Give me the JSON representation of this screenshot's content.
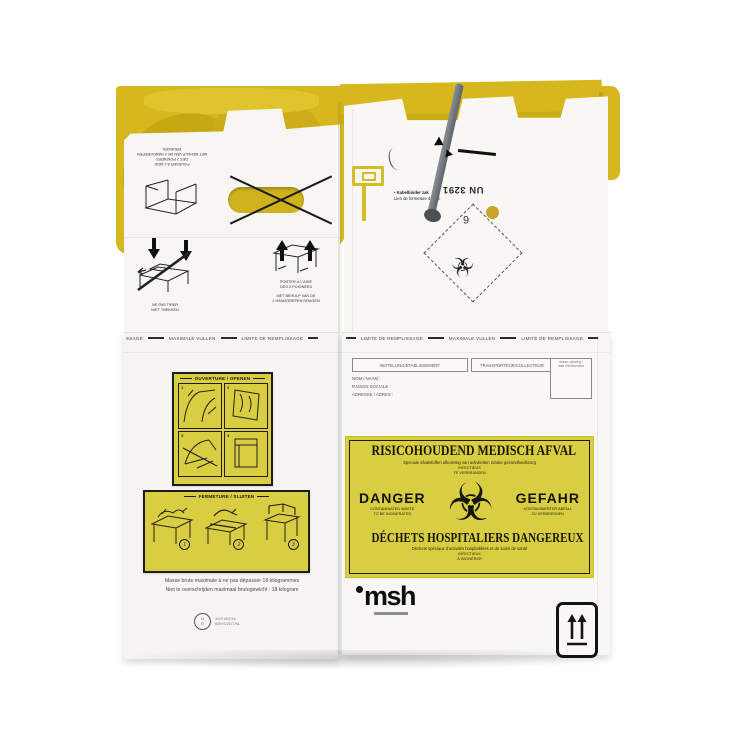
{
  "colors": {
    "bag_yellow": "#d6b81e",
    "label_yellow": "#d9cd42",
    "cardboard": "#f7f6f3",
    "cable_tie_gray": "#6e7378",
    "dot_yellow": "#c7a42b"
  },
  "icons": {
    "biohazard": "☣"
  },
  "top_flaps": {
    "push": {
      "line1": "POUSSER À L'AIDE",
      "line2": "DES 2 POIGNÉES",
      "line3": "MET BEHULP VAN DE 2 HANDGREPEN DRUKKEN"
    },
    "no_pull": {
      "line1": "NE PAS TIRER",
      "line2": "NIET TREKKEN"
    },
    "carry": {
      "line1": "PORTER À L'AIDE",
      "line2": "DES 2 POIGNÉES",
      "line3": "MET BEHULP VAN DE",
      "line4": "2 HANDGREPEN DRAGEN"
    },
    "cable_tie_note": {
      "bullet": "•",
      "line1": "Kabelbinder zak",
      "line2": "Lien de fermeture du sac"
    },
    "un_code": "UN 3291",
    "hazard_class": "6"
  },
  "fill_line": {
    "partial": "SSAGE",
    "nl": "MAXIMALE VULLEN",
    "fr": "LIMITE DE REMPLISSAGE"
  },
  "form": {
    "header1": "INSTELLING/ETABLISSEMENT",
    "header2": "TRANSPORTEUR/COLLECTEUR",
    "header3_line1": "datum ophaling /",
    "header3_line2": "date d'enlèvement",
    "row1": "NOM / NAAM :",
    "row2": "RAISON SOCIALE :",
    "row3": "ADRESSE / ADRES :"
  },
  "danger_label": {
    "title_nl": "RISICOHOUDEND MEDISCH AFVAL",
    "subtitle_nl": "Speciale afvalstoffen afkomstig van activiteiten inzake gezondheidszorg",
    "infect_nl_1": "INFECTIEUS",
    "infect_nl_2": "TE VERBRANDEN",
    "danger_en": "DANGER",
    "danger_en_sub1": "CONTAMINATED WASTE",
    "danger_en_sub2": "TO BE INCINERATED",
    "danger_de": "GEFAHR",
    "danger_de_sub1": "KONTAMINIERTER ABFALL",
    "danger_de_sub2": "ZU VERBRENNEN",
    "title_fr": "DÉCHETS HOSPITALIERS DANGEREUX",
    "subtitle_fr": "Déchets spéciaux d'activités hospitalières et de soins de santé",
    "infect_fr_1": "INFECTIEUX",
    "infect_fr_2": "À INCINÉRER"
  },
  "open_panel": {
    "title": "OUVERTURE / OPENEN",
    "steps": [
      "1",
      "2",
      "3",
      "4"
    ]
  },
  "close_panel": {
    "title": "FERMETURE / SLUITEN",
    "steps": [
      "1",
      "2",
      "3"
    ]
  },
  "weight_note": {
    "fr": "Masse brute maximale à ne pas dépasser 18 kilogrammes",
    "nl": "Niet te overschrijden maximaal brutogewicht : 18 kilogram"
  },
  "cert": {
    "mark_top": "u",
    "mark_bottom": "n",
    "line1": "4G/Y18/S/16",
    "line2": "B/BVS/2677/NL"
  },
  "brand": {
    "logo": "msh"
  }
}
